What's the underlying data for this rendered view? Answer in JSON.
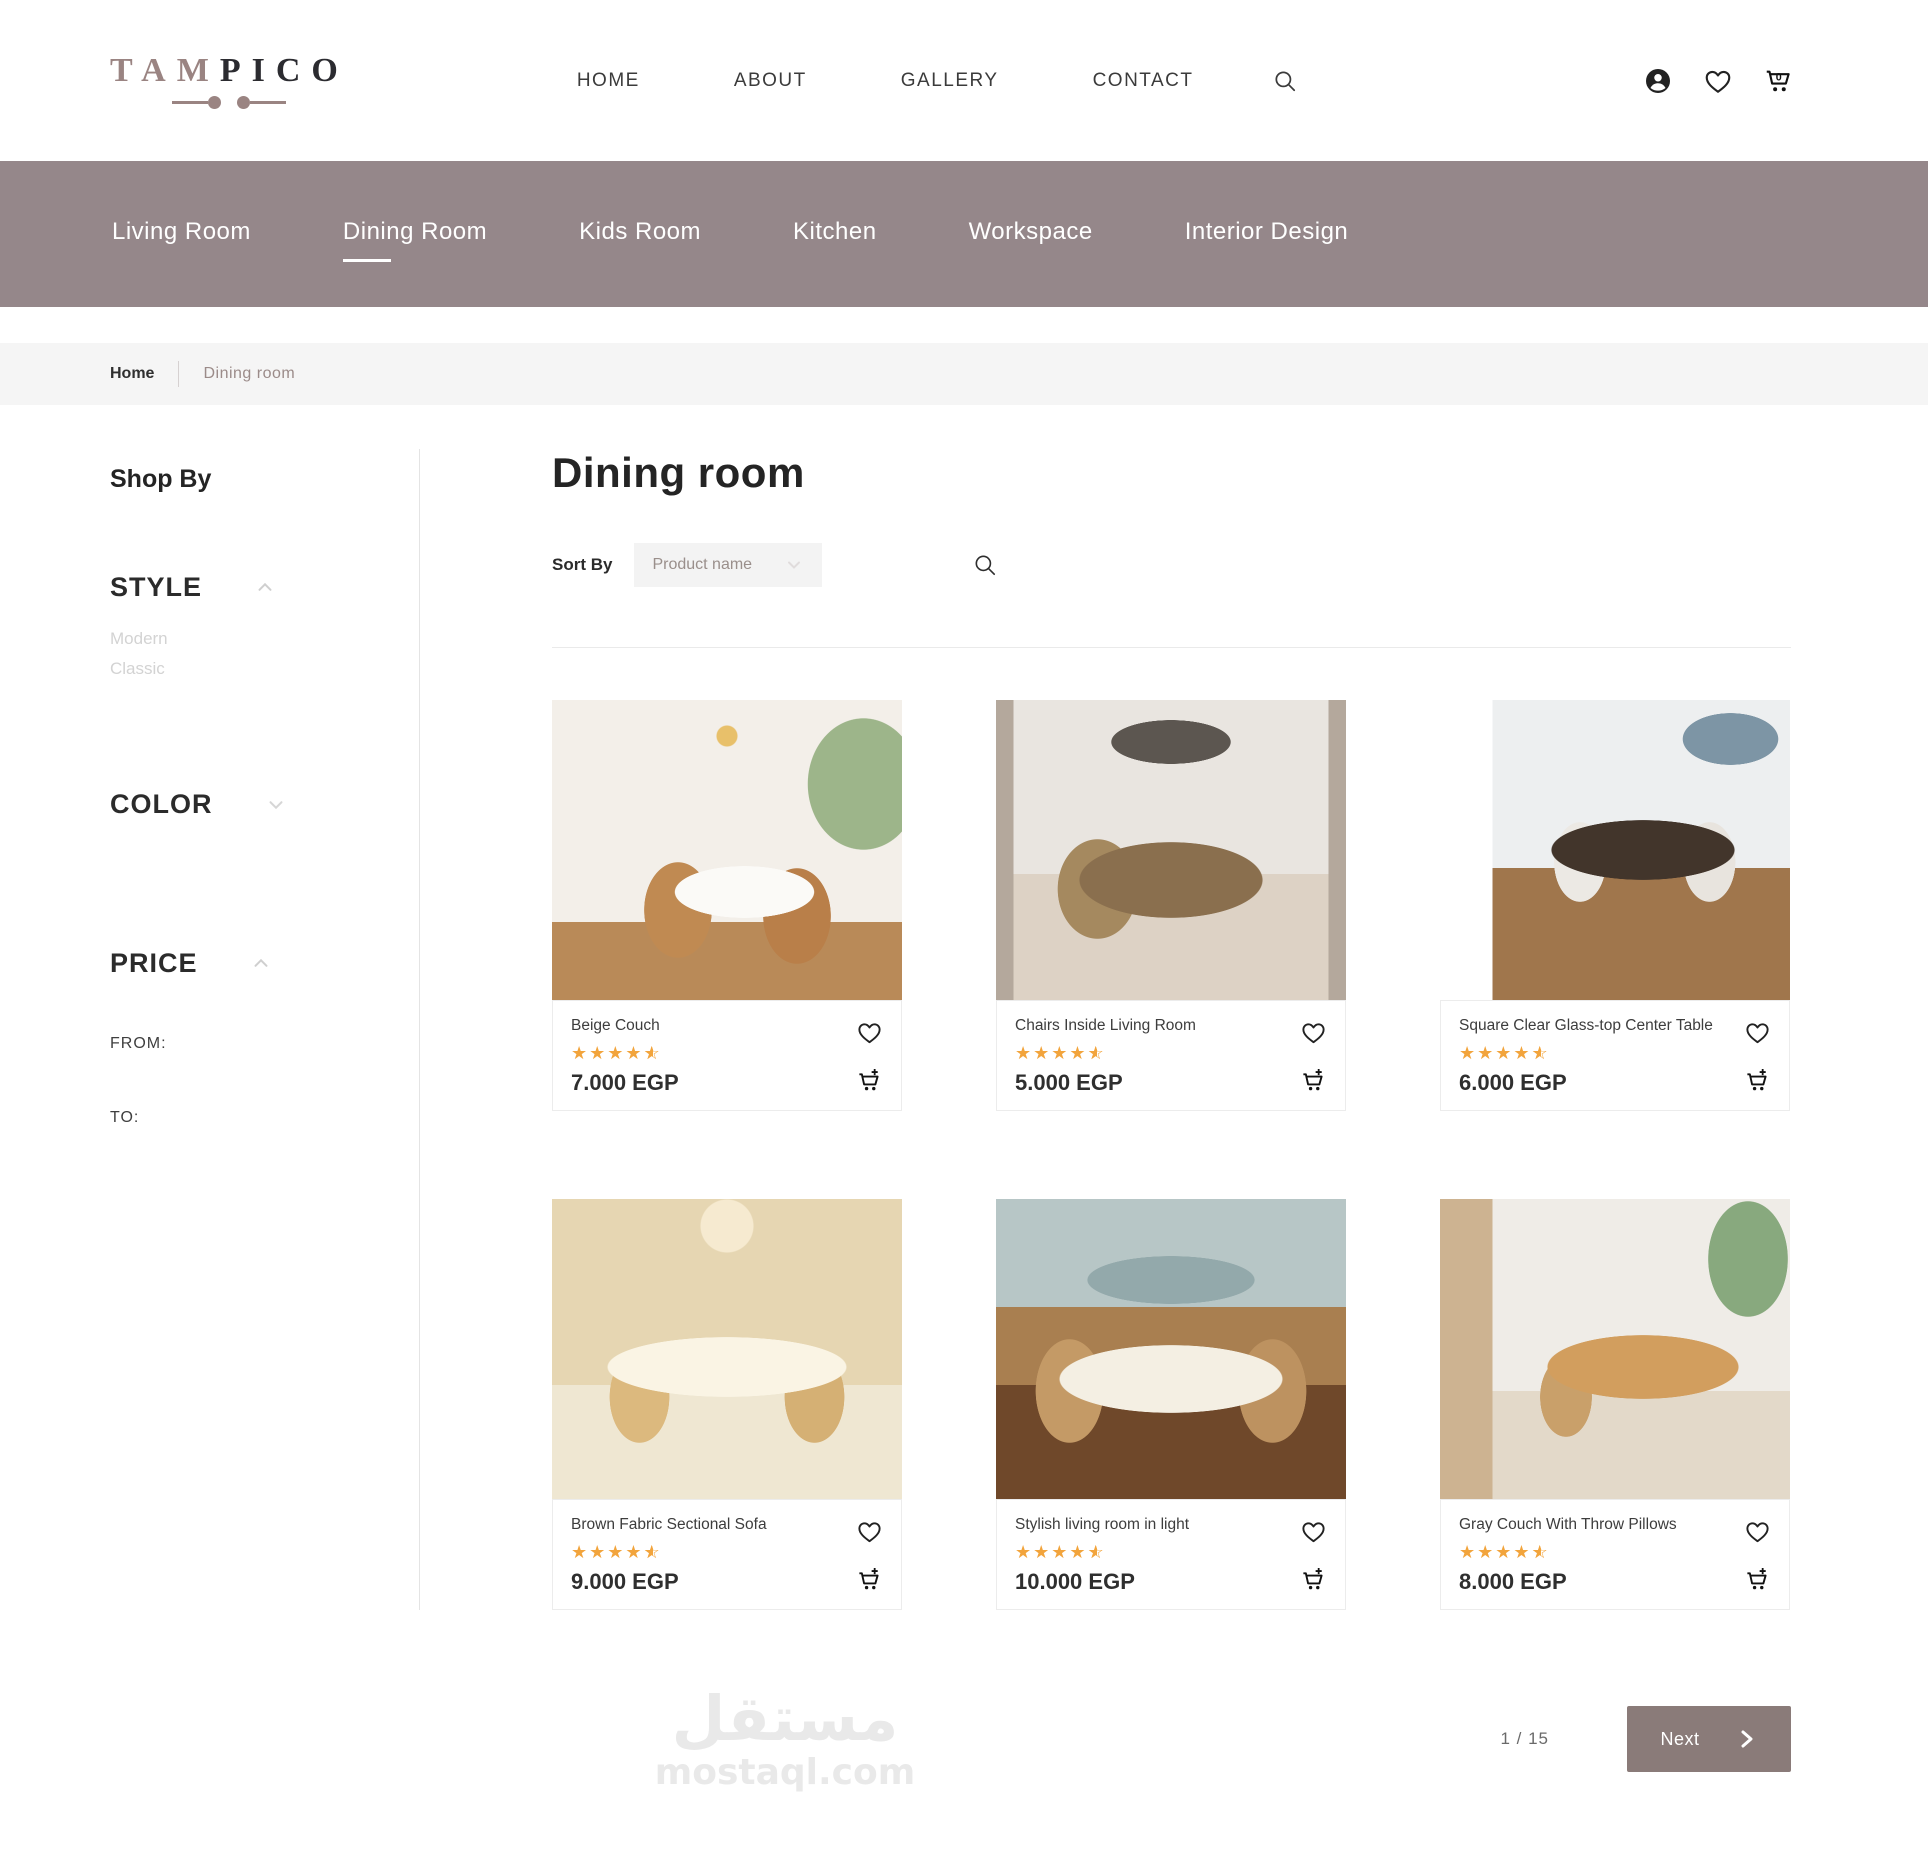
{
  "brand": {
    "name_primary": "TAM",
    "name_secondary": "PICO"
  },
  "header": {
    "nav": [
      {
        "label": "HOME"
      },
      {
        "label": "ABOUT"
      },
      {
        "label": "GALLERY"
      },
      {
        "label": "CONTACT"
      }
    ],
    "cart_count": "0"
  },
  "category_nav": {
    "items": [
      {
        "label": "Living Room",
        "active": false
      },
      {
        "label": "Dining Room",
        "active": true
      },
      {
        "label": "Kids Room",
        "active": false
      },
      {
        "label": "Kitchen",
        "active": false
      },
      {
        "label": "Workspace",
        "active": false
      },
      {
        "label": "Interior Design",
        "active": false
      }
    ]
  },
  "breadcrumb": {
    "items": [
      "Home",
      "Dining room"
    ]
  },
  "sidebar": {
    "title": "Shop By",
    "sections": [
      {
        "label": "STYLE",
        "state": "expanded",
        "options": [
          "Modern",
          "Classic"
        ]
      },
      {
        "label": "COLOR",
        "state": "collapsed",
        "options": []
      },
      {
        "label": "PRICE",
        "state": "expanded",
        "from_label": "FROM:",
        "to_label": "TO:"
      }
    ]
  },
  "main": {
    "title": "Dining room",
    "sort_label": "Sort By",
    "sort_value": "Product name",
    "products": [
      {
        "title": "Beige Couch",
        "rating": 4.5,
        "price": "7.000 EGP"
      },
      {
        "title": "Chairs Inside Living Room",
        "rating": 4.5,
        "price": "5.000 EGP"
      },
      {
        "title": "Square Clear Glass-top Center Table",
        "rating": 4.5,
        "price": "6.000 EGP"
      },
      {
        "title": "Brown Fabric Sectional Sofa",
        "rating": 4.5,
        "price": "9.000 EGP"
      },
      {
        "title": "Stylish living room in light",
        "rating": 4.5,
        "price": "10.000 EGP"
      },
      {
        "title": "Gray Couch With Throw Pillows",
        "rating": 4.5,
        "price": "8.000 EGP"
      }
    ],
    "pagination": {
      "page_indicator": "1 / 15",
      "next_label": "Next"
    }
  },
  "watermark": {
    "arabic": "مستقل",
    "latin": "mostaql.com"
  },
  "colors": {
    "accent": "#95878A",
    "accent_dark": "#8A7B79",
    "star": "#F2A43C",
    "logo_mauve": "#9A8482"
  }
}
